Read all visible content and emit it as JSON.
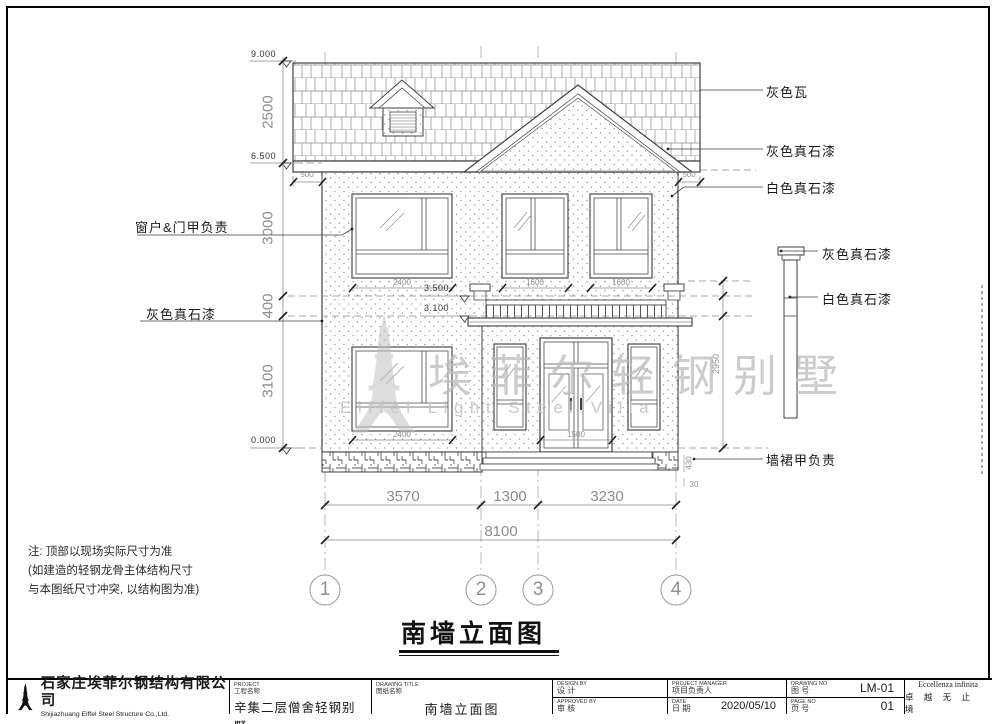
{
  "annotations": {
    "roof_tile": "灰色瓦",
    "gable_paint": "灰色真石漆",
    "eave_paint": "白色真石漆",
    "downspout_cap_paint": "灰色真石漆",
    "downspout_paint": "白色真石漆",
    "plinth_owner": "墙裙甲负责",
    "windows_doors_owner": "窗户&门甲负责",
    "band_paint": "灰色真石漆"
  },
  "elevations": {
    "top": "9.000",
    "eave": "6.500",
    "canopy_top": "3.500",
    "canopy_bottom": "3.100",
    "ground": "0.000"
  },
  "dims": {
    "v2500": "2500",
    "v3000": "3000",
    "v400": "400",
    "v3100": "3100",
    "v2950": "2950",
    "h3570": "3570",
    "h1300": "1300",
    "h3230": "3230",
    "h8100": "8100",
    "roof_overhang_left": "500",
    "roof_overhang_right": "500",
    "win2f_left": "2400",
    "win2f_mid": "1600",
    "win2f_right": "1600",
    "win1f_left": "2400",
    "door_width": "1500",
    "step_height": "430",
    "step_small": "30"
  },
  "grid_bubbles": {
    "b1": "1",
    "b2": "2",
    "b3": "3",
    "b4": "4"
  },
  "notes": {
    "l1": "注: 顶部以现场实际尺寸为准",
    "l2": "(如建造的轻钢龙骨主体结构尺寸",
    "l3": "与本图纸尺寸冲突, 以结构图为准)"
  },
  "watermark": {
    "cn": "埃菲尔轻钢别墅",
    "en": "Eiffel Light Steel Villa"
  },
  "drawing_title": {
    "text": "南墙立面图"
  },
  "title_block": {
    "company_cn": "石家庄埃菲尔钢结构有限公司",
    "company_en": "Shijiazhuang Eiffel Steel Structure Co.,Ltd.",
    "project_label_en": "PROJECT",
    "project_label_cn": "工程名称",
    "project_value": "辛集二层僧舍轻钢别墅",
    "title_label_en": "DRAWING TITLE",
    "title_label_cn": "图纸名称",
    "title_value": "南墙立面图",
    "design_label_en": "DESIGN BY",
    "design_label_cn": "设  计",
    "approved_label_en": "APPROVED BY",
    "approved_label_cn": "审  核",
    "pm_label_en": "PROJECT MANAGER",
    "pm_label_cn": "项目负责人",
    "date_label_en": "DATE",
    "date_label_cn": "日  期",
    "date_value": "2020/05/10",
    "dwgno_label_en": "DRAWING NO",
    "dwgno_label_cn": "图  号",
    "dwgno_value": "LM-01",
    "pageno_label_en": "PAGE NO",
    "pageno_label_cn": "页  号",
    "pageno_value": "01",
    "motto_en": "Eccellenza infinita",
    "motto_cn": "卓 越 无 止 境"
  },
  "colors": {
    "line": "#3f3f3f",
    "dim": "#8a8a8a",
    "watermark": "#c2c2c2"
  }
}
